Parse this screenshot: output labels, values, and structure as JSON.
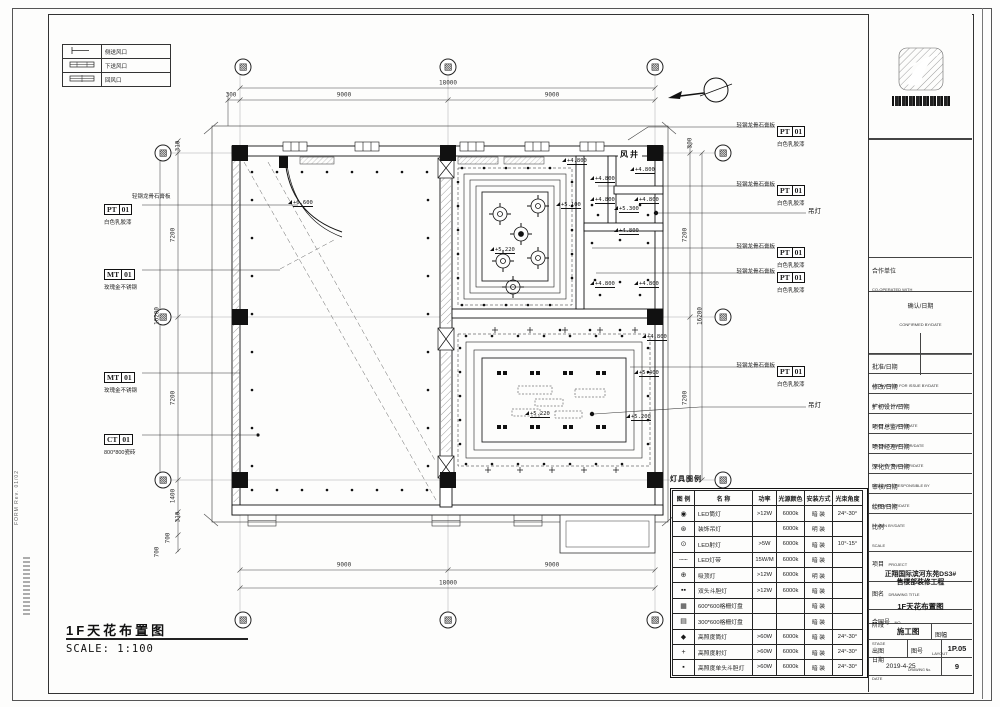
{
  "sheet": {
    "footer_title": "1F天花布置图",
    "footer_scale": "SCALE: 1:100",
    "form_text": "FORM  Rev. 01/02"
  },
  "plan": {
    "shaft_label": "风井",
    "legend_title": "灯具图例"
  },
  "hvac_legend": {
    "rows": [
      {
        "sym": "side",
        "label": "侧送风口"
      },
      {
        "sym": "down",
        "label": "下送风口"
      },
      {
        "sym": "return",
        "label": "回风口"
      }
    ]
  },
  "axis_bubble_glyph": "▧",
  "grid_bubbles": [
    {
      "x": 243,
      "y": 67
    },
    {
      "x": 448,
      "y": 67
    },
    {
      "x": 655,
      "y": 67
    },
    {
      "x": 163,
      "y": 153
    },
    {
      "x": 163,
      "y": 317
    },
    {
      "x": 163,
      "y": 480
    },
    {
      "x": 723,
      "y": 153
    },
    {
      "x": 723,
      "y": 317
    },
    {
      "x": 723,
      "y": 480
    },
    {
      "x": 243,
      "y": 620
    },
    {
      "x": 448,
      "y": 620
    },
    {
      "x": 655,
      "y": 620
    }
  ],
  "dim_labels": [
    {
      "t": "18000",
      "x": 448,
      "y": 83,
      "rot": 0
    },
    {
      "t": "9000",
      "x": 344,
      "y": 95,
      "rot": 0
    },
    {
      "t": "9000",
      "x": 552,
      "y": 95,
      "rot": 0
    },
    {
      "t": "300",
      "x": 231,
      "y": 95,
      "rot": 0
    },
    {
      "t": "9000",
      "x": 344,
      "y": 565,
      "rot": 0
    },
    {
      "t": "9000",
      "x": 552,
      "y": 565,
      "rot": 0
    },
    {
      "t": "18000",
      "x": 448,
      "y": 583,
      "rot": 0
    },
    {
      "t": "310",
      "x": 178,
      "y": 146,
      "rot": 1
    },
    {
      "t": "7200",
      "x": 173,
      "y": 235,
      "rot": 1
    },
    {
      "t": "7200",
      "x": 173,
      "y": 398,
      "rot": 1
    },
    {
      "t": "16200",
      "x": 157,
      "y": 316,
      "rot": 1
    },
    {
      "t": "1400",
      "x": 173,
      "y": 496,
      "rot": 1
    },
    {
      "t": "310",
      "x": 178,
      "y": 517,
      "rot": 1
    },
    {
      "t": "700",
      "x": 168,
      "y": 538,
      "rot": 1
    },
    {
      "t": "700",
      "x": 157,
      "y": 552,
      "rot": 1
    },
    {
      "t": "300",
      "x": 690,
      "y": 143,
      "rot": 1
    },
    {
      "t": "7200",
      "x": 685,
      "y": 235,
      "rot": 1
    },
    {
      "t": "7200",
      "x": 685,
      "y": 398,
      "rot": 1
    },
    {
      "t": "16200",
      "x": 700,
      "y": 316,
      "rot": 1
    }
  ],
  "elevations": [
    {
      "t": "+6.600",
      "x": 288,
      "y": 200
    },
    {
      "t": "+4.800",
      "x": 562,
      "y": 158
    },
    {
      "t": "+4.800",
      "x": 630,
      "y": 167
    },
    {
      "t": "+4.800",
      "x": 590,
      "y": 176
    },
    {
      "t": "+4.800",
      "x": 590,
      "y": 197
    },
    {
      "t": "+4.800",
      "x": 634,
      "y": 197
    },
    {
      "t": "+5.300",
      "x": 614,
      "y": 206
    },
    {
      "t": "+5.100",
      "x": 556,
      "y": 202
    },
    {
      "t": "+5.220",
      "x": 490,
      "y": 247
    },
    {
      "t": "+4.800",
      "x": 614,
      "y": 228
    },
    {
      "t": "+4.800",
      "x": 590,
      "y": 281
    },
    {
      "t": "+4.800",
      "x": 634,
      "y": 281
    },
    {
      "t": "+4.800",
      "x": 642,
      "y": 334
    },
    {
      "t": "+5.400",
      "x": 634,
      "y": 370
    },
    {
      "t": "+5.220",
      "x": 525,
      "y": 411
    },
    {
      "t": "+5.200",
      "x": 626,
      "y": 414
    }
  ],
  "material_tags": [
    {
      "side": "left",
      "code": "PT",
      "num": "01",
      "l1": "轻钢龙骨石膏板",
      "l2": "白色乳胶漆",
      "x": 104,
      "y": 199
    },
    {
      "side": "left",
      "code": "MT",
      "num": "01",
      "l1": "",
      "l2": "玫瑰金不锈钢",
      "x": 104,
      "y": 264
    },
    {
      "side": "left",
      "code": "MT",
      "num": "01",
      "l1": "",
      "l2": "玫瑰金不锈钢",
      "x": 104,
      "y": 367
    },
    {
      "side": "left",
      "code": "CT",
      "num": "01",
      "l1": "",
      "l2": "800*800瓷砖",
      "x": 104,
      "y": 429
    },
    {
      "side": "right",
      "code": "PT",
      "num": "01",
      "l1": "轻钢龙骨石膏板",
      "l2": "白色乳胶漆",
      "x": 777,
      "y": 121
    },
    {
      "side": "right",
      "code": "PT",
      "num": "01",
      "l1": "轻钢龙骨石膏板",
      "l2": "白色乳胶漆",
      "x": 777,
      "y": 180
    },
    {
      "side": "right",
      "code": "PT",
      "num": "01",
      "l1": "轻钢龙骨石膏板",
      "l2": "白色乳胶漆",
      "x": 777,
      "y": 242
    },
    {
      "side": "right",
      "code": "PT",
      "num": "01",
      "l1": "轻钢龙骨石膏板",
      "l2": "白色乳胶漆",
      "x": 777,
      "y": 267
    },
    {
      "side": "right",
      "code": "PT",
      "num": "01",
      "l1": "轻钢龙骨石膏板",
      "l2": "白色乳胶漆",
      "x": 777,
      "y": 361
    }
  ],
  "pendant_labels": [
    {
      "text": "吊灯",
      "x": 808,
      "y": 209
    },
    {
      "text": "吊灯",
      "x": 808,
      "y": 403
    }
  ],
  "lighting_legend": {
    "headers": [
      "图 例",
      "名  称",
      "功率",
      "光源颜色",
      "安装方式",
      "光束角度"
    ],
    "rows": [
      {
        "sym": "downlight",
        "name": "LED筒灯",
        "power": ">12W",
        "color": "6000k",
        "mount": "暗 装",
        "angle": "24°-30°"
      },
      {
        "sym": "pendant",
        "name": "装饰吊灯",
        "power": "",
        "color": "6000k",
        "mount": "明 装",
        "angle": ""
      },
      {
        "sym": "spot",
        "name": "LED射灯",
        "power": ">5W",
        "color": "6000k",
        "mount": "暗 装",
        "angle": "10°-15°"
      },
      {
        "sym": "strip",
        "name": "LED灯带",
        "power": "15W/M",
        "color": "6000k",
        "mount": "暗 装",
        "angle": ""
      },
      {
        "sym": "ceiling",
        "name": "吸顶灯",
        "power": ">12W",
        "color": "6000k",
        "mount": "明 装",
        "angle": ""
      },
      {
        "sym": "double",
        "name": "双头斗胆灯",
        "power": ">12W",
        "color": "6000k",
        "mount": "暗 装",
        "angle": ""
      },
      {
        "sym": "grille600",
        "name": "600*600格栅灯盘",
        "power": "",
        "color": "",
        "mount": "暗 装",
        "angle": ""
      },
      {
        "sym": "grille300",
        "name": "300*600格栅灯盘",
        "power": "",
        "color": "",
        "mount": "暗 装",
        "angle": ""
      },
      {
        "sym": "hi_downlight",
        "name": "高照度筒灯",
        "power": ">60W",
        "color": "6000k",
        "mount": "暗 装",
        "angle": "24°-30°"
      },
      {
        "sym": "hi_spot",
        "name": "高照度射灯",
        "power": ">60W",
        "color": "6000k",
        "mount": "暗 装",
        "angle": "24°-30°"
      },
      {
        "sym": "hi_double",
        "name": "高照度单头斗胆灯",
        "power": ">60W",
        "color": "6000k",
        "mount": "暗 装",
        "angle": "24°-30°"
      }
    ]
  },
  "title_block": {
    "rows": [
      {
        "zh": "合作单位",
        "en": "CO-OPERATED WITH",
        "h": 34,
        "style": "tall"
      },
      {
        "zh": "确认/日期",
        "en": "CONFIRMED BY/DATE",
        "h": 20,
        "style": "center"
      },
      {
        "zh": "批准/日期",
        "en": "AUTHORIZED FOR ISSUE BY/DATE",
        "h": 20,
        "style": ""
      },
      {
        "zh": "修改/日期",
        "en": "REVISED BY/DATE",
        "h": 20,
        "style": ""
      },
      {
        "zh": "扩初设计/日期",
        "en": "CHIEF DESIGNER/DATE",
        "h": 20,
        "style": ""
      },
      {
        "zh": "项目总监/日期",
        "en": "PROJECT DIRECTOR/DATE",
        "h": 20,
        "style": ""
      },
      {
        "zh": "项目经理/日期",
        "en": "PROJECT MANAGER/DATE",
        "h": 20,
        "style": ""
      },
      {
        "zh": "深化负责/日期",
        "en": "DRAWINGS RESPONSIBLE BY",
        "h": 20,
        "style": ""
      },
      {
        "zh": "审核/日期",
        "en": "CHECKED BY/DATE",
        "h": 20,
        "style": ""
      },
      {
        "zh": "绘图/日期",
        "en": "DRAWN BY/DATE",
        "h": 20,
        "style": ""
      }
    ],
    "scale_zh": "比例",
    "scale_en": "SCALE",
    "project_zh": "项目",
    "project_en": "PROJECT",
    "project_name_line1": "正翔国际滨河东苑DS3#",
    "project_name_line2": "售楼部装修工程",
    "title_zh": "图名",
    "title_en": "DRAWING TITLE",
    "drawing_title": "1F天花布置图",
    "contract_zh": "合同号",
    "contract_en": "NO.",
    "stage_zh": "阶段",
    "stage_en": "STAGE",
    "stage_value": "施工图",
    "layout_zh": "图幅",
    "layout_en": "LAYOUT",
    "issue_zh": "出图",
    "drawno_zh": "图号",
    "drawno_en": "DRAWING No.",
    "drawing_number": "1P.05",
    "date_zh": "日期",
    "date_en": "DATE",
    "date_value": "2019-4-25",
    "sheet_no": "9"
  }
}
